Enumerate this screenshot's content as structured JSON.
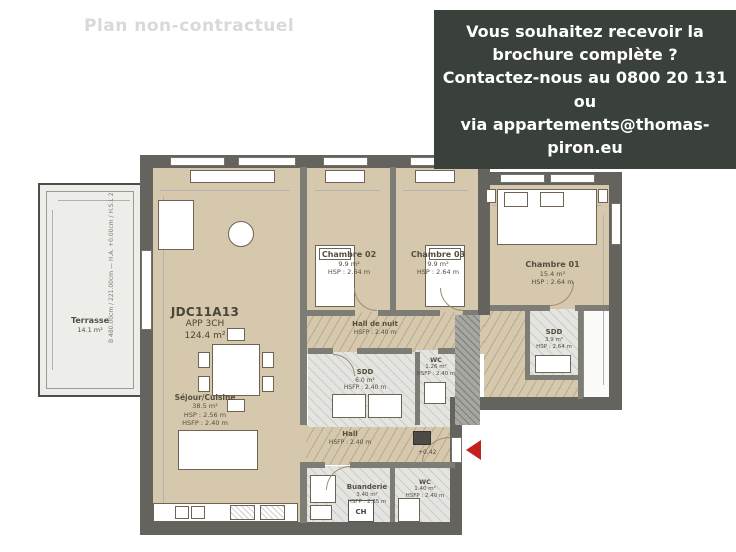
{
  "watermark": "Plan non-contractuel",
  "info_box": {
    "lines": [
      "Vous souhaitez recevoir la",
      "brochure complète ?",
      "Contactez-nous au 0800 20 131 ou",
      "via appartements@thomas-piron.eu"
    ],
    "background": "#3a403a",
    "text_color": "#ffffff"
  },
  "apartment": {
    "code": "JDC11A13",
    "type": "APP 3CH",
    "area": "124.4 m²"
  },
  "rooms": {
    "terrasse": {
      "name": "Terrasse",
      "area": "14.1 m²",
      "note": "B 480.00cm / 221.00cm — H.A. +0.00cm / H.S.L 226.00cm — C. Coulissant"
    },
    "sejour": {
      "name": "Séjour/Cuisine",
      "area": "38.5 m²",
      "hsp": "HSP : 2.56 m",
      "hsfp": "HSFP : 2.40 m"
    },
    "chambre02": {
      "name": "Chambre 02",
      "area": "9.9 m²",
      "hsp": "HSP : 2.64 m"
    },
    "chambre03": {
      "name": "Chambre 03",
      "area": "9.9 m²",
      "hsp": "HSP : 2.64 m"
    },
    "chambre01": {
      "name": "Chambre 01",
      "area": "15.4 m²",
      "hsp": "HSP : 2.64 m"
    },
    "hall_de_nuit": {
      "name": "Hall de nuit",
      "hsfp": "HSFP : 2.40 m"
    },
    "sdd_centrale": {
      "name": "SDD",
      "area": "6.0 m²",
      "hsfp": "HSFP : 2.40 m"
    },
    "wc_centrale": {
      "name": "WC",
      "area": "1.26 m²",
      "hsfp": "HSFP : 2.40 m"
    },
    "sdd_chambre01": {
      "name": "SDD",
      "area": "3.9 m²",
      "hsp": "HSP : 2.64 m"
    },
    "hall": {
      "name": "Hall",
      "hsfp": "HSFP : 2.40 m"
    },
    "buanderie": {
      "name": "Buanderie",
      "area": "3.40 m²",
      "hsfp": "HSFP : 2.35 m"
    },
    "wc_hall": {
      "name": "WC",
      "area": "1.40 m²",
      "hsfp": "HSFP : 2.40 m"
    }
  },
  "markers": {
    "level": "+0.42",
    "boiler": "CH"
  },
  "colors": {
    "room_fill": "#d6c8ac",
    "wall": "#64635e",
    "entrance_arrow": "#c4201d",
    "watermark": "#d9d9d9"
  }
}
